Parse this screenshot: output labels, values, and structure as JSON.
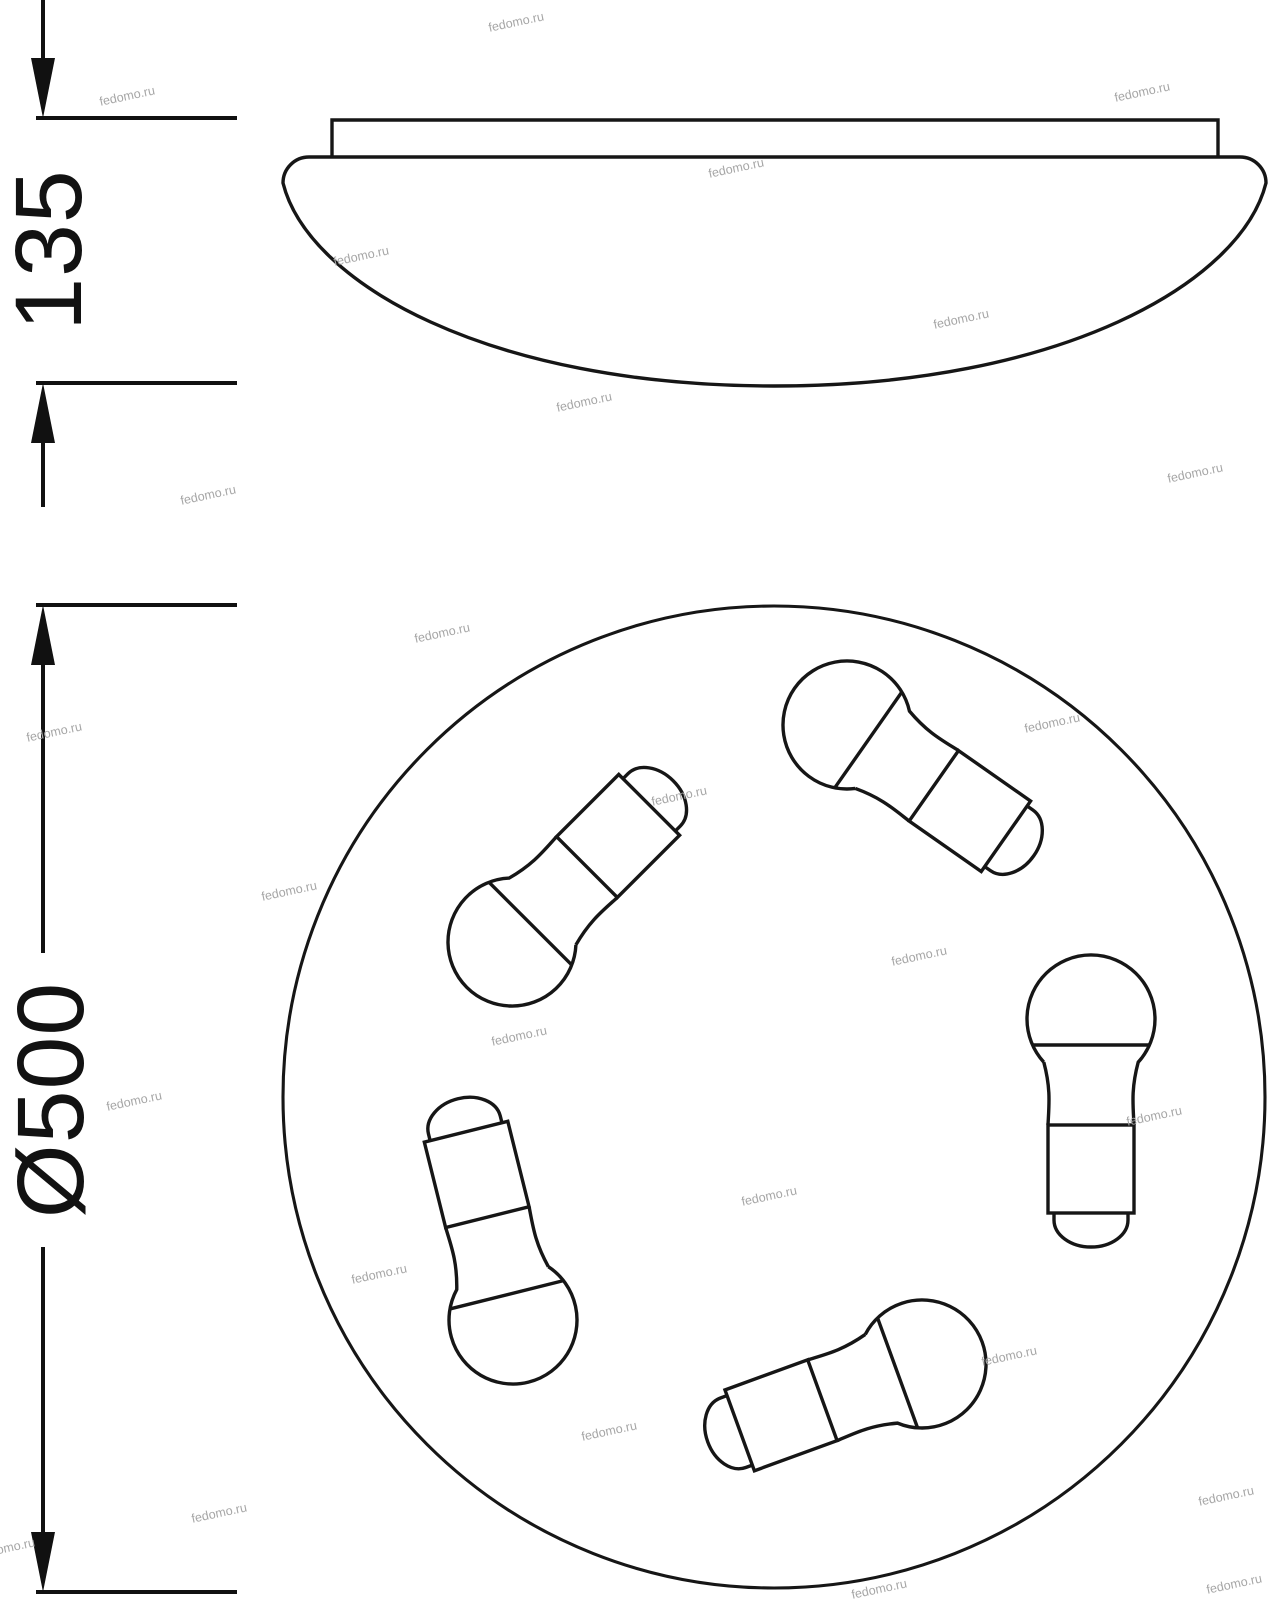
{
  "drawing": {
    "side_view": {
      "height_label": "135"
    },
    "top_view": {
      "diameter_label": "Ø500",
      "bulb_count": 5
    }
  },
  "watermark": {
    "text": "fedomo.ru"
  }
}
